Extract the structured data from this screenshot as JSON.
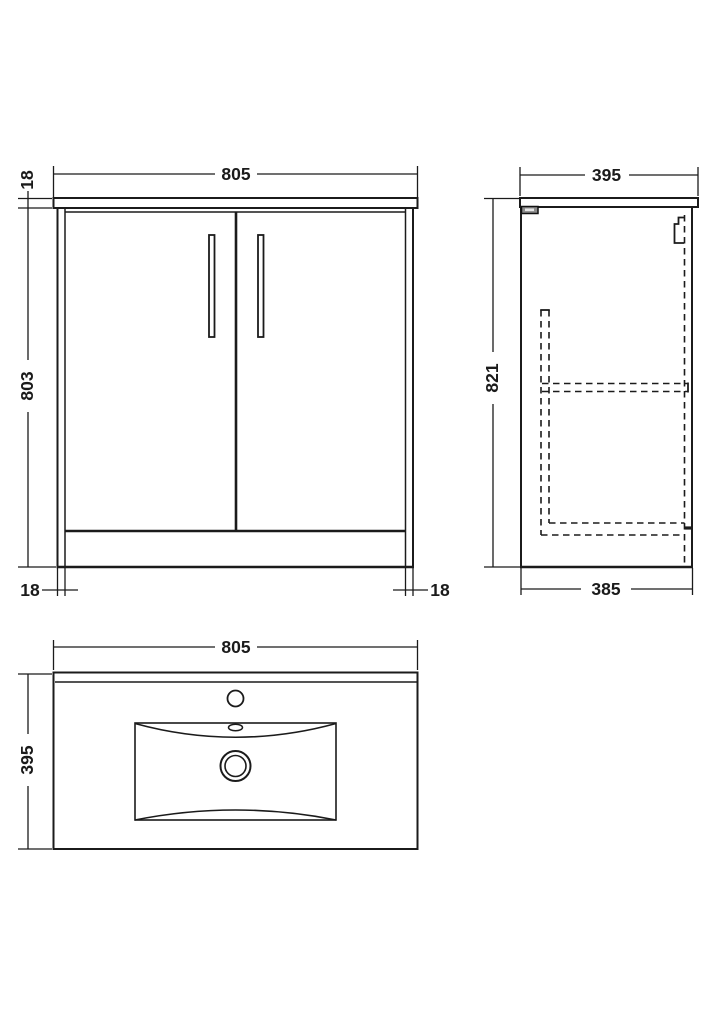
{
  "drawing": {
    "kind": "bathroom-vanity-technical-drawing",
    "views": {
      "front": {
        "label": "front-elevation",
        "width": "805",
        "worktop_thickness": "18",
        "cabinet_height": "803",
        "left_panel_thickness": "18",
        "right_panel_thickness": "18"
      },
      "side": {
        "label": "side-elevation",
        "worktop_depth": "395",
        "overall_height": "821",
        "cabinet_depth": "385"
      },
      "basin": {
        "label": "basin-plan-view",
        "width": "805",
        "depth": "395"
      }
    },
    "colors": {
      "line": "#1b1b1b",
      "background": "#ffffff",
      "bracket_fill": "#8c8c8c"
    }
  }
}
